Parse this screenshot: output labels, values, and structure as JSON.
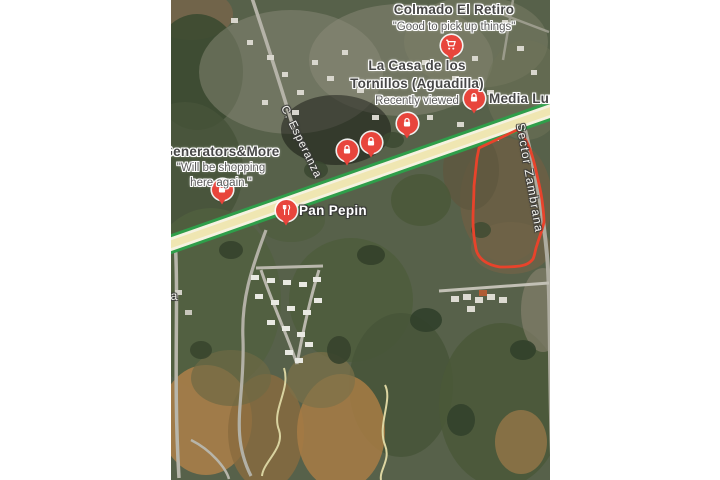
{
  "map": {
    "description": "satellite-map-view",
    "pois": [
      {
        "name": "Colmado El Retiro",
        "review": "\"Good to pick up things\"",
        "icon": "shopping-cart"
      },
      {
        "name": "La Casa de los Tornillos (Aguadilla)",
        "status": "Recently viewed",
        "icon": "lock"
      },
      {
        "name": "Media Luna",
        "icon": "lock"
      },
      {
        "name": "Generators&More",
        "review": "\"Will be shopping here again.\"",
        "icon": "lock"
      },
      {
        "name": "Pan Pepin",
        "icon": "restaurant"
      }
    ],
    "extra_markers": [
      {
        "icon": "lock"
      },
      {
        "icon": "lock"
      },
      {
        "icon": "lock"
      }
    ],
    "road_labels": [
      {
        "name": "C. Esperanza"
      },
      {
        "name": "Sector Zambrana"
      }
    ],
    "edge_label": "la",
    "colors": {
      "pin_red": "#e8453c",
      "route_green": "#2f9e4a",
      "route_yellow": "#efe6b2",
      "parcel_outline": "#e8432b"
    }
  }
}
